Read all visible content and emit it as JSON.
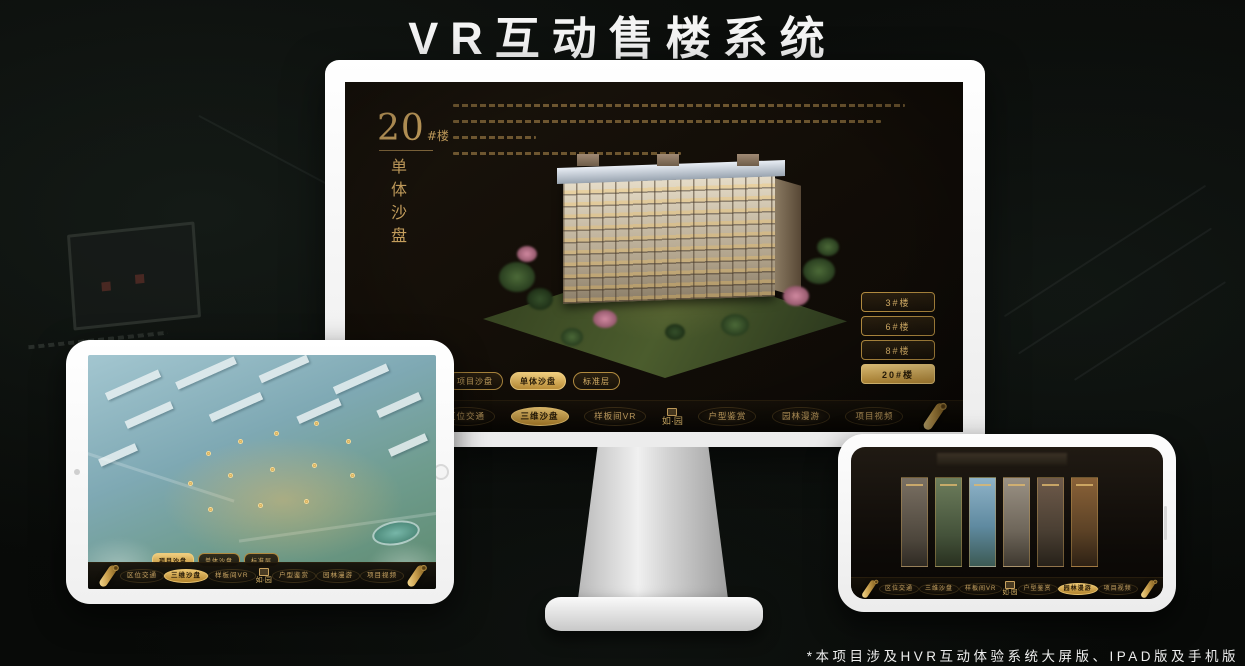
{
  "title": "VR互动售楼系统",
  "footnote": "*本项目涉及HVR互动体验系统大屏版、IPAD版及手机版",
  "colors": {
    "gold": "#c9a25f",
    "gold_active": "#ecc671",
    "screen_bg": "#14100b",
    "active_text": "#2a1d08"
  },
  "nav": {
    "items": [
      {
        "label": "区位交通"
      },
      {
        "label": "三维沙盘"
      },
      {
        "label": "样板间VR"
      },
      {
        "label": "户型鉴赏"
      },
      {
        "label": "园林漫游"
      },
      {
        "label": "项目视频"
      }
    ],
    "logo": "如·园"
  },
  "desktop_app": {
    "floor_number": "20",
    "floor_unit": "#楼",
    "mode_vertical_label": "单体沙盘",
    "floor_buttons": [
      {
        "label": "3#楼"
      },
      {
        "label": "6#楼"
      },
      {
        "label": "8#楼"
      },
      {
        "label": "20#楼"
      }
    ],
    "active_floor": "20#楼",
    "view_tabs": [
      {
        "label": "项目沙盘"
      },
      {
        "label": "单体沙盘"
      },
      {
        "label": "标准层"
      }
    ],
    "active_tab": "单体沙盘",
    "active_nav": "三维沙盘"
  },
  "tablet_app": {
    "view_tabs": [
      {
        "label": "项目沙盘"
      },
      {
        "label": "单体沙盘"
      },
      {
        "label": "标准层"
      }
    ],
    "active_tab": "项目沙盘",
    "active_nav": "三维沙盘"
  },
  "phone_app": {
    "active_nav": "园林漫游",
    "gallery_panel_count": "6"
  }
}
